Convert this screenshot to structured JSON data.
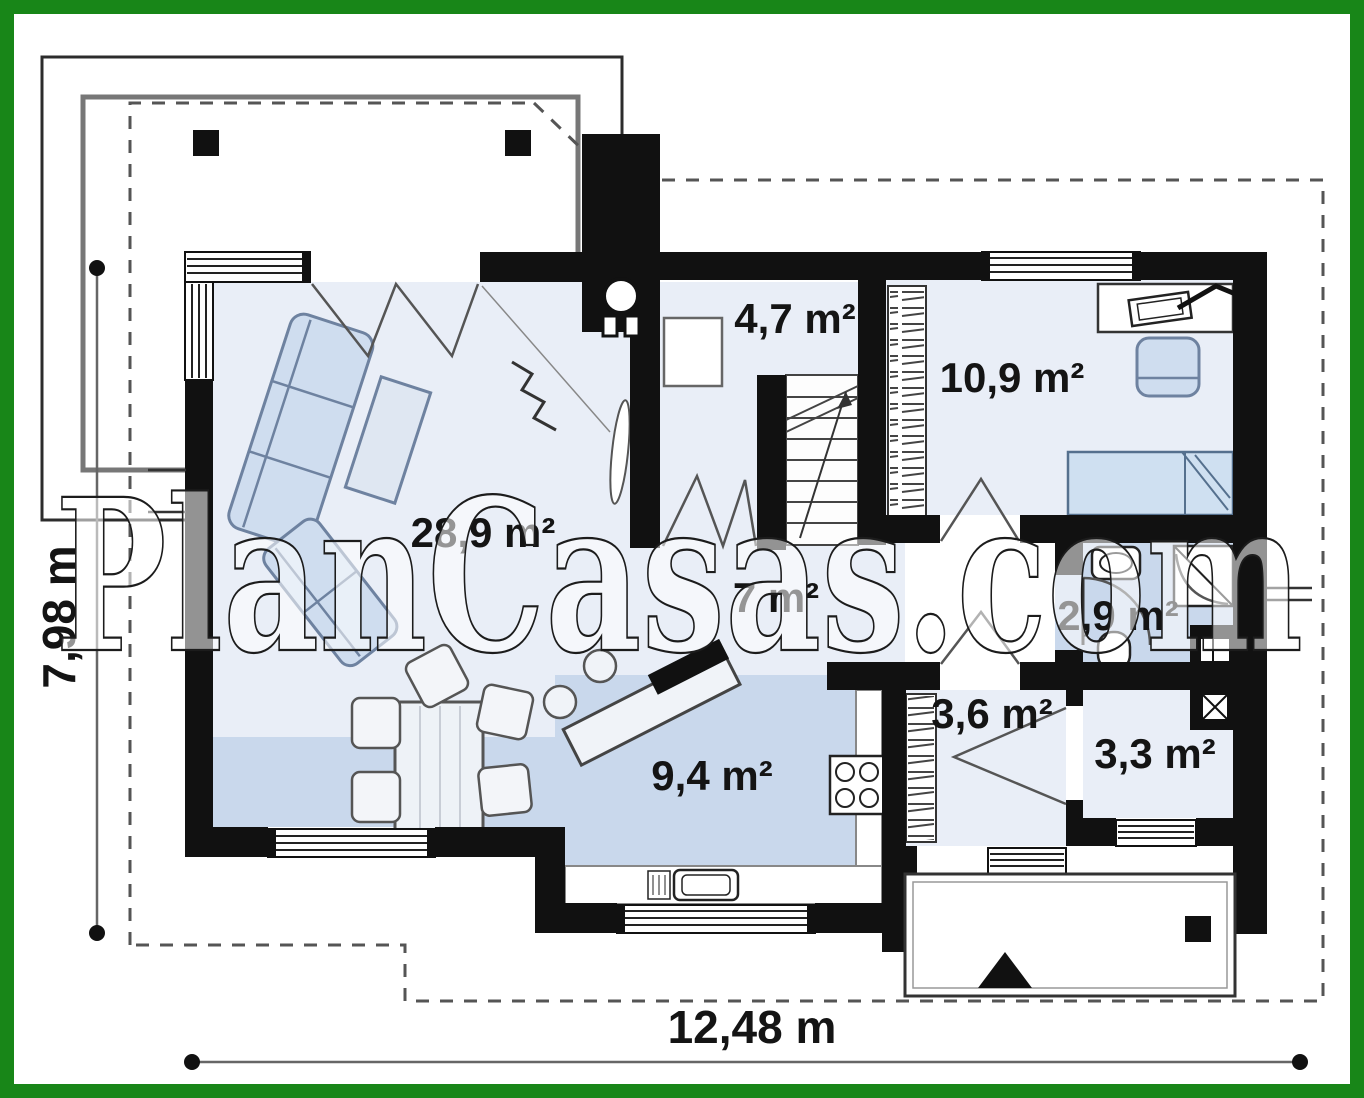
{
  "watermark": {
    "text": "PlanCasas.com"
  },
  "dimensions": {
    "width_label": "12,48 m",
    "height_label": "7,98 m"
  },
  "rooms": [
    {
      "name": "living-room",
      "area": "28,9 m²"
    },
    {
      "name": "kitchen",
      "area": "9,4 m²"
    },
    {
      "name": "hall",
      "area": "7 m²"
    },
    {
      "name": "pantry",
      "area": "4,7 m²"
    },
    {
      "name": "bedroom",
      "area": "10,9 m²"
    },
    {
      "name": "bathroom",
      "area": "2,9 m²"
    },
    {
      "name": "entry-hall",
      "area": "3,6 m²"
    },
    {
      "name": "wc",
      "area": "3,3 m²"
    }
  ],
  "colors": {
    "frame": "#188618",
    "wall": "#111111",
    "floor_light": "#e9eef7",
    "floor_medium": "#c9d8ec",
    "furniture": "#cfddef"
  }
}
